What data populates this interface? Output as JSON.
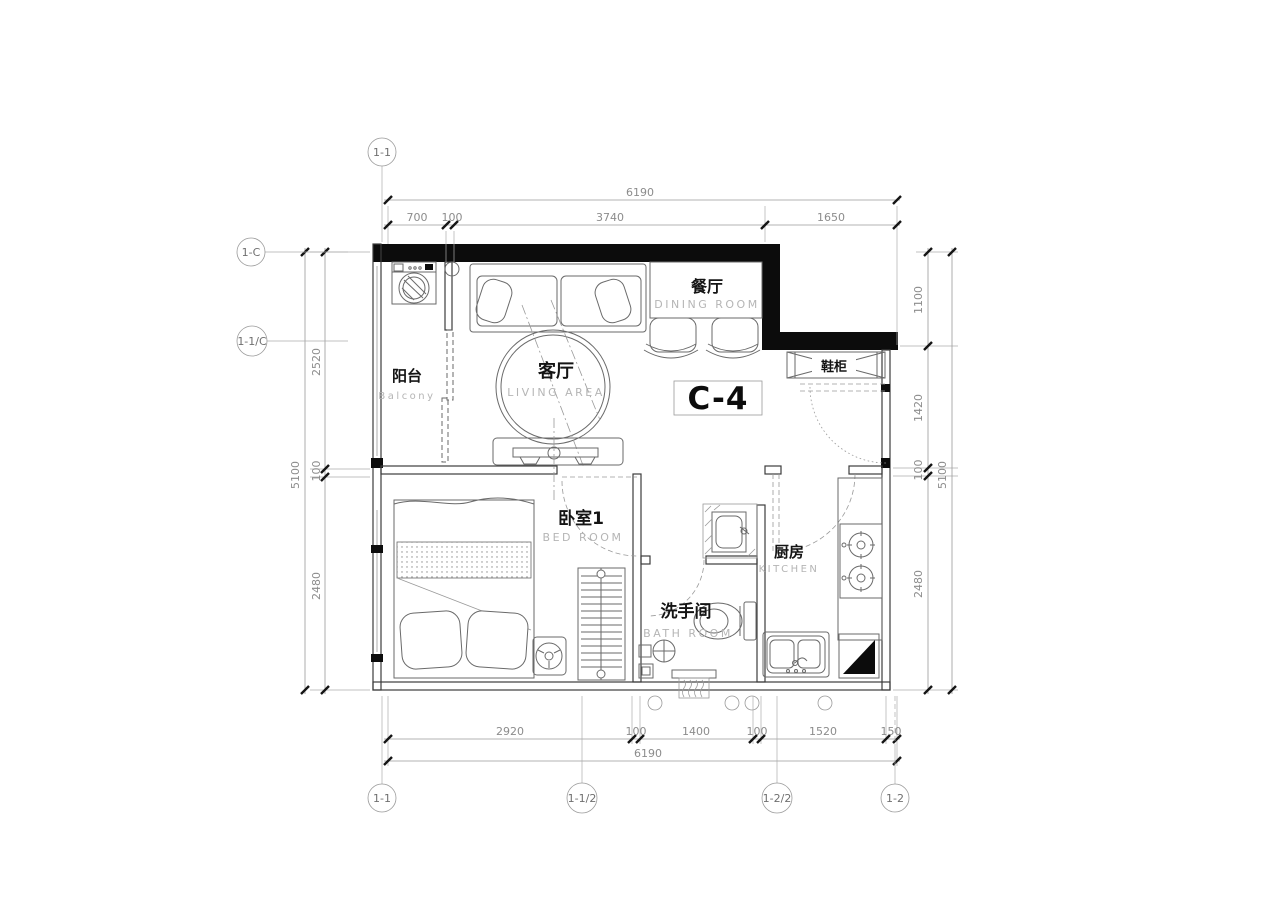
{
  "unit_label": "C-4",
  "rooms": {
    "balcony": {
      "cn": "阳台",
      "en": "Balcony"
    },
    "living": {
      "cn": "客厅",
      "en": "LIVING AREA"
    },
    "dining": {
      "cn": "餐厅",
      "en": "DINING ROOM"
    },
    "bedroom": {
      "cn": "卧室1",
      "en": "BED ROOM"
    },
    "bathroom": {
      "cn": "洗手间",
      "en": "BATH ROOM"
    },
    "kitchen": {
      "cn": "厨房",
      "en": "KITCHEN"
    },
    "shoe_cabinet": {
      "cn": "鞋柜"
    }
  },
  "dimensions": {
    "top": {
      "overall": "6190",
      "segments": [
        "700",
        "100",
        "3740",
        "1650"
      ]
    },
    "bottom": {
      "overall": "6190",
      "segments": [
        "2920",
        "100",
        "1400",
        "100",
        "1520",
        "150"
      ]
    },
    "left": {
      "overall": "5100",
      "segments": [
        "2520",
        "100",
        "2480"
      ]
    },
    "right": {
      "overall": "5100",
      "segments": [
        "1100",
        "1420",
        "100",
        "2480"
      ]
    }
  },
  "grid_markers": {
    "top_left": "1-1",
    "left_upper": "1-C",
    "left_lower": "1-1/C",
    "bottom": [
      "1-1",
      "1-1/2",
      "1-2/2",
      "1-2"
    ]
  },
  "colors": {
    "wall": "#0c0c0c",
    "furniture_line": "#6a6a6a",
    "dim_text": "#8c8c8c",
    "label_en": "#b5b5b5"
  }
}
